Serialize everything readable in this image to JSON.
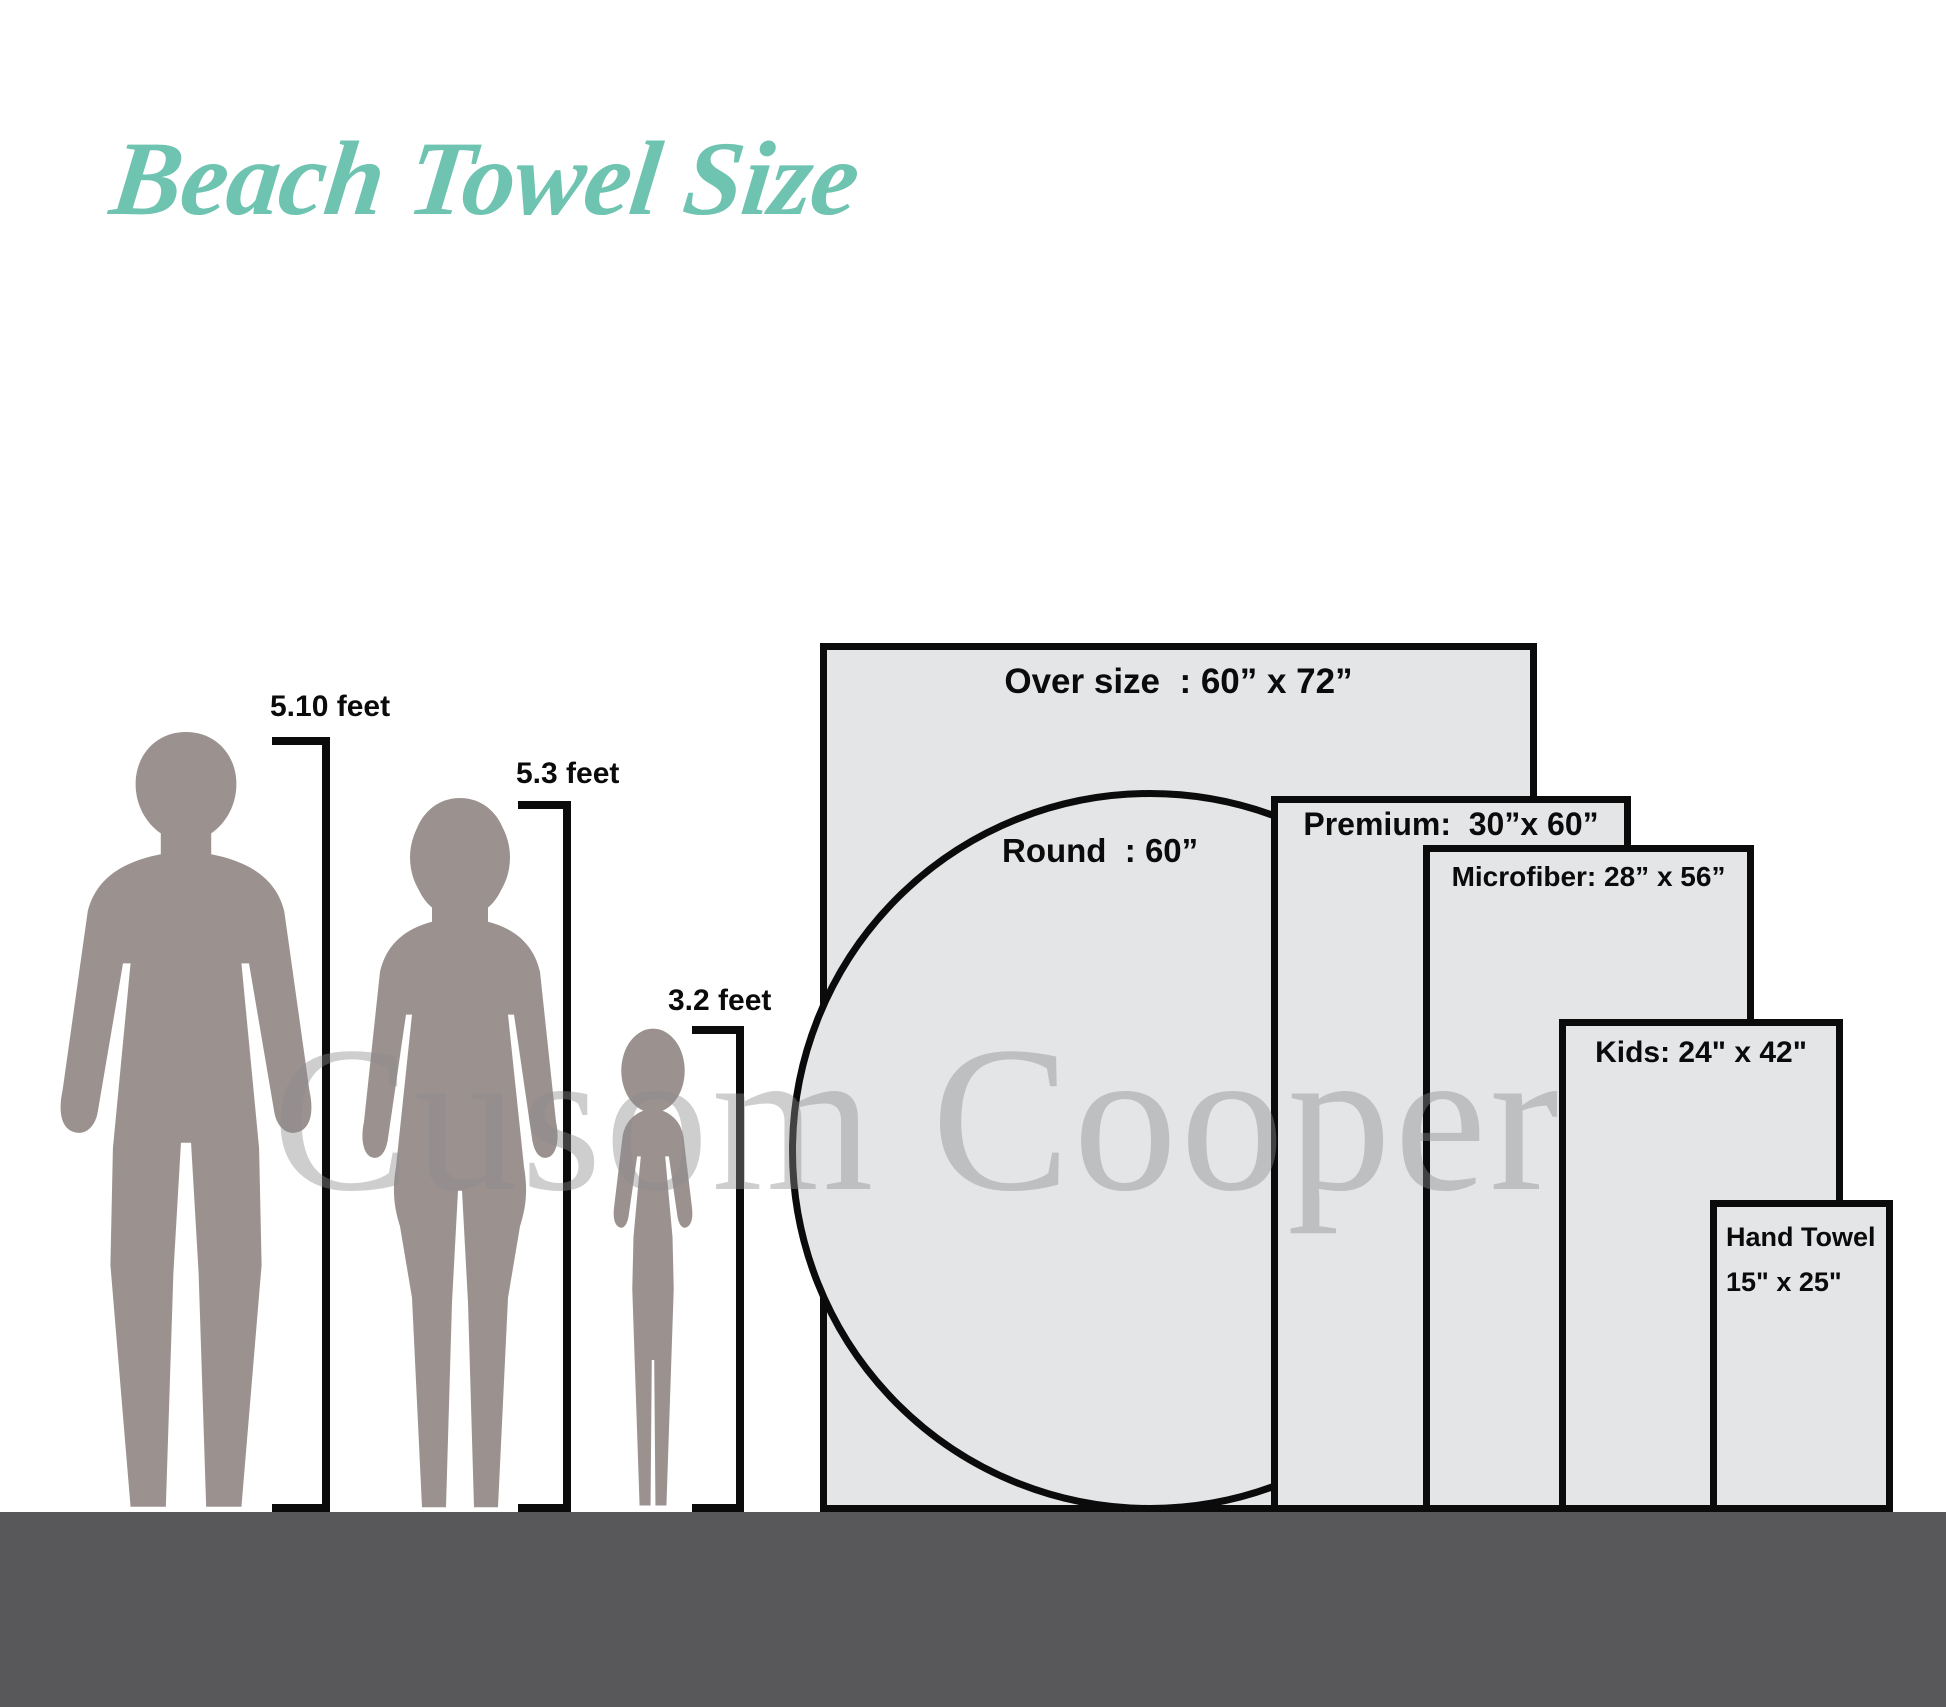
{
  "title": "Beach Towel Size",
  "watermark": "Cusom Cooper",
  "figures": {
    "man": {
      "label": "5.10 feet"
    },
    "woman": {
      "label": "5.3 feet"
    },
    "child": {
      "label": "3.2 feet"
    }
  },
  "towels": {
    "oversize": {
      "label": "Over size  : 60” x 72”"
    },
    "round": {
      "label": "Round  : 60”"
    },
    "premium": {
      "label": "Premium:  30”x 60”"
    },
    "microfiber": {
      "label": "Microfiber: 28” x 56”"
    },
    "kids": {
      "label": "Kids: 24\" x 42\""
    },
    "hand": {
      "line1": "Hand Towel",
      "line2": "15\" x 25\""
    }
  },
  "colors": {
    "accent_teal": "#6ec4b0",
    "towel_fill": "#e4e5e7",
    "outline_black": "#0b0b0b",
    "ground_gray": "#58585a",
    "silhouette_gray": "#9b9290",
    "watermark_gray": "#8c8c8c"
  }
}
